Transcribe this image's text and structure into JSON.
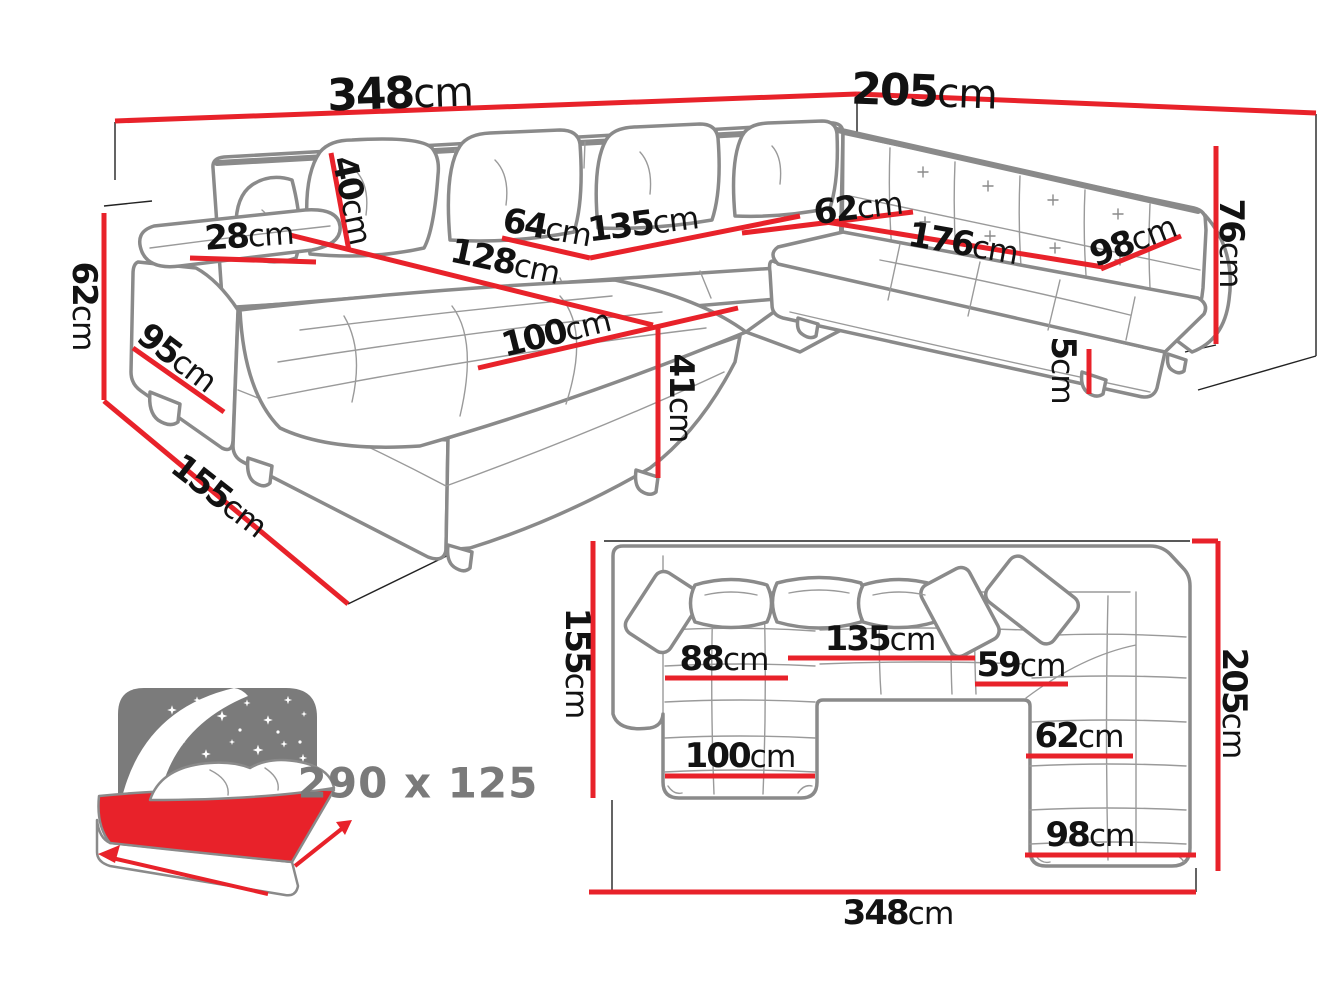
{
  "colors": {
    "dimension_red": "#e8222a",
    "sofa_outline_gray": "#8a8a8a",
    "text_black": "#121212",
    "icon_gray": "#7a7a7a",
    "background": "#ffffff"
  },
  "views": [
    {
      "id": "perspective",
      "dimensions": [
        {
          "name": "total-width-left",
          "value": "348",
          "unit": "cm",
          "label_x": 400,
          "label_y": 94,
          "rotate": -2,
          "size": 44,
          "line": [
            115,
            121,
            857,
            94
          ]
        },
        {
          "name": "total-width-right",
          "value": "205",
          "unit": "cm",
          "label_x": 924,
          "label_y": 92,
          "rotate": 2,
          "size": 44,
          "line": [
            857,
            94,
            1316,
            113
          ]
        },
        {
          "name": "back-cushion-height",
          "value": "40",
          "unit": "cm",
          "label_x": 352,
          "label_y": 200,
          "rotate": 78,
          "line": [
            331,
            153,
            349,
            251
          ]
        },
        {
          "name": "armrest-width",
          "value": "28",
          "unit": "cm",
          "label_x": 249,
          "label_y": 236,
          "rotate": -4,
          "line": [
            190,
            258,
            316,
            262
          ]
        },
        {
          "name": "seat-width-left",
          "value": "64",
          "unit": "cm",
          "label_x": 547,
          "label_y": 228,
          "rotate": 10,
          "line": [
            502,
            238,
            590,
            258
          ]
        },
        {
          "name": "seat-width-middle",
          "value": "135",
          "unit": "cm",
          "label_x": 643,
          "label_y": 224,
          "rotate": -7,
          "line": [
            590,
            258,
            800,
            216
          ]
        },
        {
          "name": "seat-depth-right",
          "value": "62",
          "unit": "cm",
          "label_x": 858,
          "label_y": 208,
          "rotate": -7,
          "line": [
            742,
            233,
            913,
            212
          ]
        },
        {
          "name": "seat-width-right",
          "value": "176",
          "unit": "cm",
          "label_x": 963,
          "label_y": 244,
          "rotate": 10,
          "line": [
            820,
            221,
            1103,
            267
          ]
        },
        {
          "name": "right-end-width",
          "value": "98",
          "unit": "cm",
          "label_x": 1133,
          "label_y": 241,
          "rotate": -21,
          "line": [
            1101,
            269,
            1181,
            236
          ]
        },
        {
          "name": "backrest-height",
          "value": "76",
          "unit": "cm",
          "label_x": 1231,
          "label_y": 243,
          "rotate": 90,
          "line": [
            1216,
            146,
            1216,
            344
          ]
        },
        {
          "name": "leg-height",
          "value": "5",
          "unit": "cm",
          "label_x": 1063,
          "label_y": 370,
          "rotate": 90,
          "line": [
            1089,
            349,
            1089,
            394
          ]
        },
        {
          "name": "side-height",
          "value": "62",
          "unit": "cm",
          "label_x": 84,
          "label_y": 306,
          "rotate": 90,
          "line": [
            104,
            213,
            104,
            400
          ]
        },
        {
          "name": "armrest-front-height",
          "value": "95",
          "unit": "cm",
          "label_x": 177,
          "label_y": 358,
          "rotate": 37,
          "line": [
            133,
            348,
            224,
            412
          ]
        },
        {
          "name": "side-depth",
          "value": "155",
          "unit": "cm",
          "label_x": 219,
          "label_y": 496,
          "rotate": 38,
          "line": [
            104,
            401,
            348,
            604
          ]
        },
        {
          "name": "chaise-length",
          "value": "128",
          "unit": "cm",
          "label_x": 505,
          "label_y": 262,
          "rotate": 12,
          "line": [
            290,
            235,
            653,
            325
          ]
        },
        {
          "name": "chaise-width",
          "value": "100",
          "unit": "cm",
          "label_x": 556,
          "label_y": 333,
          "rotate": -14,
          "line": [
            478,
            368,
            738,
            308
          ]
        },
        {
          "name": "seat-height",
          "value": "41",
          "unit": "cm",
          "label_x": 681,
          "label_y": 398,
          "rotate": 90,
          "line": [
            658,
            326,
            658,
            478
          ]
        }
      ],
      "extra_red_segments": []
    },
    {
      "id": "plan",
      "dimensions": [
        {
          "name": "plan-depth-left",
          "value": "155",
          "unit": "cm",
          "label_x": 577,
          "label_y": 663,
          "rotate": 90,
          "line": [
            593,
            541,
            593,
            798
          ]
        },
        {
          "name": "plan-depth-right",
          "value": "205",
          "unit": "cm",
          "label_x": 1234,
          "label_y": 703,
          "rotate": 90,
          "line": [
            1218,
            541,
            1218,
            871
          ]
        },
        {
          "name": "plan-total-width",
          "value": "348",
          "unit": "cm",
          "label_x": 898,
          "label_y": 913,
          "rotate": 0,
          "line": [
            589,
            892,
            1196,
            892
          ]
        },
        {
          "name": "plan-chaise-seat",
          "value": "88",
          "unit": "cm",
          "label_x": 724,
          "label_y": 659,
          "rotate": 0,
          "line": [
            665,
            678,
            788,
            678
          ]
        },
        {
          "name": "plan-middle-seat",
          "value": "135",
          "unit": "cm",
          "label_x": 880,
          "label_y": 639,
          "rotate": 0,
          "line": [
            788,
            658,
            975,
            658
          ]
        },
        {
          "name": "plan-corner-seat",
          "value": "59",
          "unit": "cm",
          "label_x": 1021,
          "label_y": 665,
          "rotate": 0,
          "line": [
            975,
            684,
            1068,
            684
          ]
        },
        {
          "name": "plan-right-seat",
          "value": "62",
          "unit": "cm",
          "label_x": 1079,
          "label_y": 736,
          "rotate": 0,
          "line": [
            1026,
            756,
            1133,
            756
          ]
        },
        {
          "name": "plan-chaise-width",
          "value": "100",
          "unit": "cm",
          "label_x": 740,
          "label_y": 756,
          "rotate": 0,
          "line": [
            665,
            776,
            815,
            776
          ]
        },
        {
          "name": "plan-right-width",
          "value": "98",
          "unit": "cm",
          "label_x": 1090,
          "label_y": 835,
          "rotate": 0,
          "line": [
            1025,
            855,
            1196,
            855
          ]
        }
      ],
      "extra_red_segments": [
        [
          1192,
          541,
          1218,
          541
        ]
      ]
    }
  ],
  "sleeping_function": {
    "label": "290 x 125"
  }
}
